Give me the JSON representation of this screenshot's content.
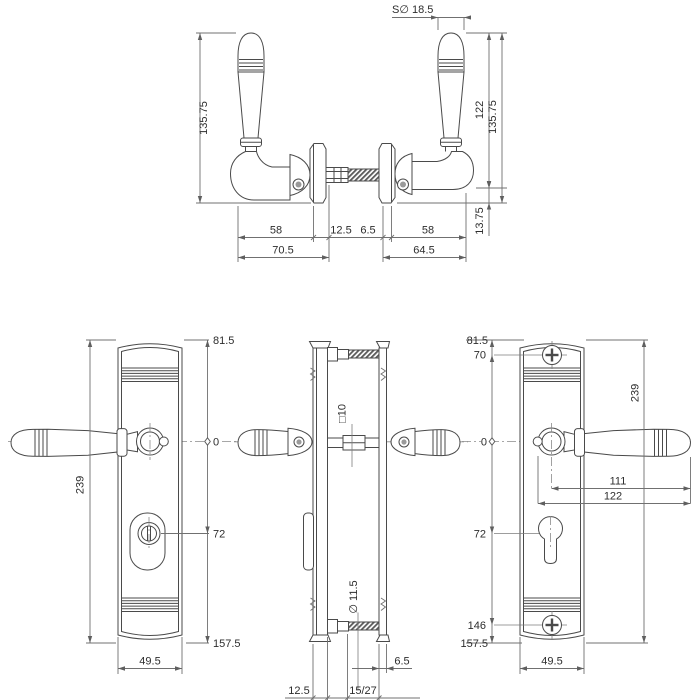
{
  "palette": {
    "background": "#ffffff",
    "drawing_line": "#4a4a4a",
    "dimension_line": "#707070",
    "text": "#2d2d2d",
    "thread_hatch": "#5a5a5a"
  },
  "views": {
    "top": {
      "sphere_dia": "S∅ 18.5",
      "height_left": "135.75",
      "height_to_arm": "122",
      "height_right": "135.75",
      "arm_to_base": "13.75",
      "grip_left": "58",
      "rose_left": "12.5",
      "rose_right": "6.5",
      "grip_right": "58",
      "total_left": "70.5",
      "total_right": "64.5"
    },
    "front_left": {
      "height": "239",
      "top": "81.5",
      "zero": "0",
      "cylinder": "72",
      "bottom": "157.5",
      "width": "49.5"
    },
    "side": {
      "spindle": "□10",
      "screw_dia": "∅ 11.5",
      "outer_plate": "6.5",
      "inner_plate": "12.5",
      "clamp_range": "15/27"
    },
    "front_right": {
      "top": "81.5",
      "screw_top": "70",
      "zero": "0",
      "cylinder": "72",
      "screw_bottom": "146",
      "bottom": "157.5",
      "height": "239",
      "lever_length": "111",
      "lever_overall": "122",
      "width": "49.5"
    }
  }
}
